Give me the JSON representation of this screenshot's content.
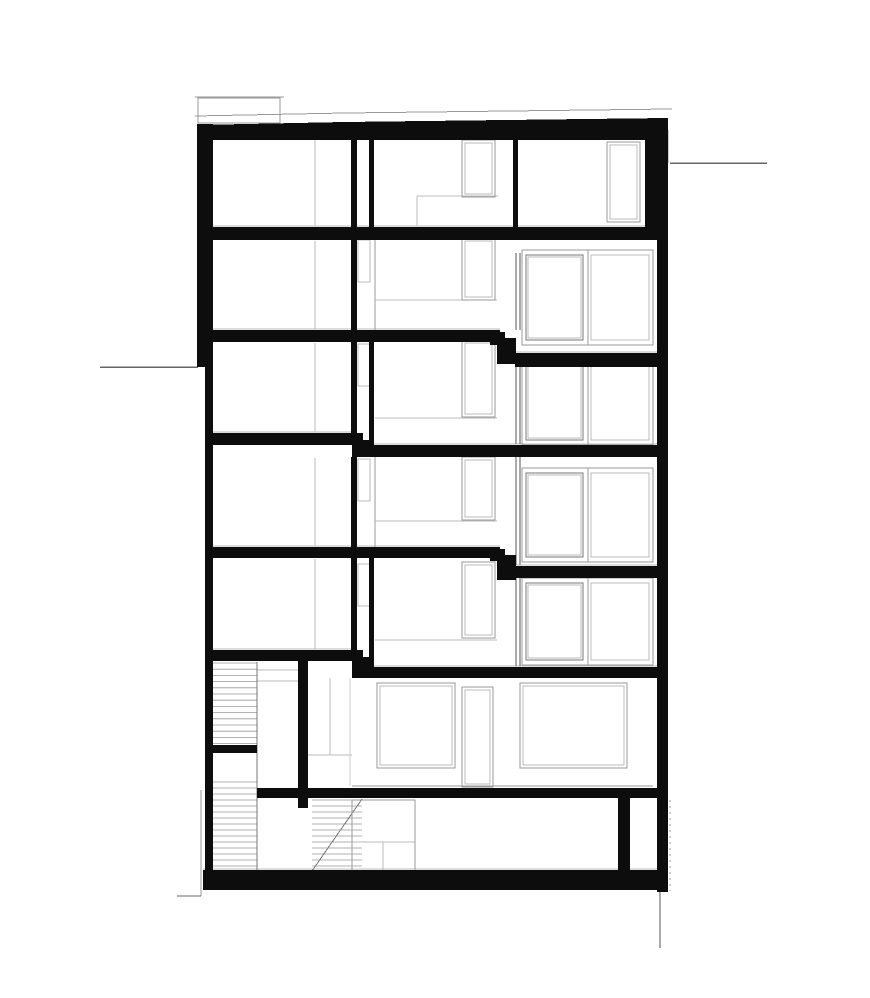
{
  "title": "building-section-drawing",
  "canvas": {
    "width": 870,
    "height": 998,
    "background": "#ffffff"
  },
  "colors": {
    "cut": "#0d0d0d",
    "thin": "#999999",
    "mid": "#777777",
    "light": "#bbbbbb",
    "faint": "#cccccc",
    "dark": "#555555",
    "grade": "#666666"
  },
  "drawing": {
    "roof_polygon": {
      "name": "roof-slab",
      "points": [
        [
          197,
          125
        ],
        [
          345,
          122
        ],
        [
          668,
          118
        ],
        [
          668,
          140
        ],
        [
          197,
          140
        ]
      ]
    },
    "black_rects": [
      {
        "name": "exterior-wall-left-upper",
        "r": [
          197,
          124,
          16,
          243
        ]
      },
      {
        "name": "exterior-wall-left-lower",
        "r": [
          205,
          367,
          8,
          519
        ]
      },
      {
        "name": "exterior-wall-right-top",
        "r": [
          645,
          124,
          23,
          116
        ]
      },
      {
        "name": "exterior-wall-right",
        "r": [
          657,
          240,
          11,
          652
        ]
      },
      {
        "name": "floor-slab-2",
        "r": [
          213,
          227,
          445,
          13
        ]
      },
      {
        "name": "partition-wall-top-floor",
        "r": [
          513,
          140,
          5,
          87
        ]
      },
      {
        "name": "floor-slab-3-left",
        "r": [
          213,
          330,
          287,
          12
        ]
      },
      {
        "name": "slab-step",
        "r": [
          490,
          332,
          15,
          13
        ]
      },
      {
        "name": "slab-step",
        "r": [
          497,
          338,
          19,
          26
        ]
      },
      {
        "name": "floor-slab-3-right",
        "r": [
          515,
          353,
          143,
          14
        ]
      },
      {
        "name": "floor-slab-4-left",
        "r": [
          213,
          433,
          139,
          12
        ]
      },
      {
        "name": "slab-step",
        "r": [
          352,
          433,
          11,
          13
        ]
      },
      {
        "name": "slab-step",
        "r": [
          352,
          440,
          21,
          17
        ]
      },
      {
        "name": "floor-slab-4-right",
        "r": [
          370,
          445,
          288,
          12
        ]
      },
      {
        "name": "floor-slab-5-left",
        "r": [
          213,
          547,
          287,
          11
        ]
      },
      {
        "name": "slab-step",
        "r": [
          490,
          549,
          15,
          12
        ]
      },
      {
        "name": "slab-step",
        "r": [
          497,
          555,
          19,
          25
        ]
      },
      {
        "name": "floor-slab-5-right",
        "r": [
          515,
          566,
          143,
          12
        ]
      },
      {
        "name": "floor-slab-6-left",
        "r": [
          213,
          650,
          139,
          11
        ]
      },
      {
        "name": "slab-step",
        "r": [
          352,
          650,
          11,
          12
        ]
      },
      {
        "name": "slab-step",
        "r": [
          352,
          657,
          21,
          21
        ]
      },
      {
        "name": "floor-slab-6-right",
        "r": [
          370,
          667,
          288,
          11
        ]
      },
      {
        "name": "interior-wall",
        "r": [
          351,
          139,
          6,
          88
        ]
      },
      {
        "name": "interior-wall",
        "r": [
          351,
          240,
          6,
          90
        ]
      },
      {
        "name": "interior-wall",
        "r": [
          351,
          342,
          6,
          98
        ]
      },
      {
        "name": "interior-wall",
        "r": [
          351,
          457,
          6,
          90
        ]
      },
      {
        "name": "interior-wall",
        "r": [
          351,
          558,
          6,
          99
        ]
      },
      {
        "name": "interior-wall",
        "r": [
          369,
          140,
          5,
          87
        ]
      },
      {
        "name": "interior-wall",
        "r": [
          369,
          342,
          5,
          103
        ]
      },
      {
        "name": "interior-wall",
        "r": [
          369,
          558,
          5,
          109
        ]
      },
      {
        "name": "stair-core-wall",
        "r": [
          298,
          661,
          10,
          147
        ]
      },
      {
        "name": "stair-landing-slab",
        "r": [
          205,
          745,
          52,
          8
        ]
      },
      {
        "name": "garden-level-slab",
        "r": [
          257,
          788,
          401,
          10
        ]
      },
      {
        "name": "foundation-slab",
        "r": [
          203,
          870,
          465,
          20
        ]
      },
      {
        "name": "basement-wall",
        "r": [
          618,
          798,
          12,
          74
        ]
      }
    ],
    "lines": [
      {
        "name": "roof-edge-line",
        "l": [
          195,
          116,
          345,
          113
        ],
        "c": "thin",
        "w": 1
      },
      {
        "name": "roof-edge-line",
        "l": [
          345,
          113,
          672,
          109
        ],
        "c": "thin",
        "w": 1
      },
      {
        "name": "chimney-top-line",
        "l": [
          195,
          97,
          284,
          97
        ],
        "c": "thin",
        "w": 1
      },
      {
        "name": "grade-line-right",
        "l": [
          670,
          163,
          767,
          163
        ],
        "c": "grade",
        "w": 1.5
      },
      {
        "name": "grade-line-right-v",
        "l": [
          668,
          130,
          668,
          163
        ],
        "c": "thin",
        "w": 1
      },
      {
        "name": "grade-line-left",
        "l": [
          100,
          367,
          198,
          367
        ],
        "c": "grade",
        "w": 1.5
      },
      {
        "name": "footing-line-left-v",
        "l": [
          201,
          790,
          201,
          896
        ],
        "c": "thin",
        "w": 1
      },
      {
        "name": "footing-line-left-h",
        "l": [
          177,
          896,
          201,
          896
        ],
        "c": "grade",
        "w": 1
      },
      {
        "name": "footing-line-right",
        "l": [
          660,
          892,
          660,
          948
        ],
        "c": "dark",
        "w": 1
      },
      {
        "name": "slab-finish-line",
        "l": [
          213,
          226,
          658,
          226
        ],
        "c": "light",
        "w": 1
      },
      {
        "name": "slab-finish-line",
        "l": [
          213,
          329,
          500,
          329
        ],
        "c": "light",
        "w": 1
      },
      {
        "name": "slab-finish-line",
        "l": [
          515,
          352,
          658,
          352
        ],
        "c": "light",
        "w": 1
      },
      {
        "name": "slab-finish-line",
        "l": [
          213,
          432,
          352,
          432
        ],
        "c": "light",
        "w": 1
      },
      {
        "name": "slab-finish-line",
        "l": [
          370,
          444,
          658,
          444
        ],
        "c": "light",
        "w": 1
      },
      {
        "name": "slab-finish-line",
        "l": [
          213,
          546,
          500,
          546
        ],
        "c": "light",
        "w": 1
      },
      {
        "name": "slab-finish-line",
        "l": [
          515,
          565,
          658,
          565
        ],
        "c": "light",
        "w": 1
      },
      {
        "name": "slab-finish-line",
        "l": [
          213,
          649,
          352,
          649
        ],
        "c": "light",
        "w": 1
      },
      {
        "name": "slab-finish-line",
        "l": [
          370,
          666,
          658,
          666
        ],
        "c": "light",
        "w": 1
      },
      {
        "name": "slab-finish-line",
        "l": [
          203,
          869,
          668,
          869
        ],
        "c": "light",
        "w": 1
      },
      {
        "name": "door-frame-line",
        "l": [
          315,
          140,
          315,
          226
        ],
        "c": "light",
        "w": 1
      },
      {
        "name": "door-frame-line",
        "l": [
          315,
          241,
          315,
          329
        ],
        "c": "light",
        "w": 1
      },
      {
        "name": "door-frame-line",
        "l": [
          315,
          343,
          315,
          432
        ],
        "c": "light",
        "w": 1
      },
      {
        "name": "door-frame-line",
        "l": [
          315,
          458,
          315,
          546
        ],
        "c": "light",
        "w": 1
      },
      {
        "name": "door-frame-line",
        "l": [
          315,
          559,
          315,
          649
        ],
        "c": "light",
        "w": 1
      },
      {
        "name": "shaft-edge-line",
        "l": [
          375,
          240,
          375,
          330
        ],
        "c": "thin",
        "w": 1
      },
      {
        "name": "shaft-edge-line",
        "l": [
          375,
          457,
          375,
          547
        ],
        "c": "thin",
        "w": 1
      },
      {
        "name": "partition-edge-line",
        "l": [
          516,
          253,
          516,
          330
        ],
        "c": "dark",
        "w": 1
      },
      {
        "name": "partition-edge-line",
        "l": [
          520,
          253,
          520,
          330
        ],
        "c": "dark",
        "w": 1
      },
      {
        "name": "partition-edge-line",
        "l": [
          516,
          365,
          516,
          444
        ],
        "c": "dark",
        "w": 1
      },
      {
        "name": "partition-edge-line",
        "l": [
          520,
          365,
          520,
          444
        ],
        "c": "dark",
        "w": 1
      },
      {
        "name": "partition-edge-line",
        "l": [
          516,
          457,
          516,
          565
        ],
        "c": "dark",
        "w": 1
      },
      {
        "name": "partition-edge-line",
        "l": [
          520,
          457,
          520,
          565
        ],
        "c": "dark",
        "w": 1
      },
      {
        "name": "partition-edge-line",
        "l": [
          516,
          578,
          516,
          666
        ],
        "c": "dark",
        "w": 1
      },
      {
        "name": "partition-edge-line",
        "l": [
          520,
          578,
          520,
          666
        ],
        "c": "dark",
        "w": 1
      },
      {
        "name": "loft-outline",
        "l": [
          417,
          196,
          498,
          196
        ],
        "c": "light",
        "w": 1
      },
      {
        "name": "loft-outline",
        "l": [
          417,
          196,
          417,
          226
        ],
        "c": "light",
        "w": 1
      },
      {
        "name": "interior-floor-line",
        "l": [
          375,
          300,
          497,
          300
        ],
        "c": "light",
        "w": 1
      },
      {
        "name": "interior-floor-line",
        "l": [
          375,
          418,
          497,
          418
        ],
        "c": "light",
        "w": 1
      },
      {
        "name": "interior-floor-line",
        "l": [
          375,
          521,
          497,
          521
        ],
        "c": "light",
        "w": 1
      },
      {
        "name": "interior-floor-line",
        "l": [
          375,
          640,
          497,
          640
        ],
        "c": "light",
        "w": 1
      },
      {
        "name": "garden-floor-line",
        "l": [
          352,
          786,
          653,
          786
        ],
        "c": "thin",
        "w": 1
      },
      {
        "name": "garden-partition-line",
        "l": [
          330,
          678,
          330,
          755
        ],
        "c": "light",
        "w": 1
      },
      {
        "name": "garden-partition-line",
        "l": [
          308,
          755,
          352,
          755
        ],
        "c": "light",
        "w": 1
      },
      {
        "name": "garden-partition-line",
        "l": [
          350,
          678,
          350,
          786
        ],
        "c": "faint",
        "w": 1
      },
      {
        "name": "stair-landing-line",
        "l": [
          257,
          670,
          298,
          670
        ],
        "c": "light",
        "w": 1
      },
      {
        "name": "stair-landing-line",
        "l": [
          257,
          681,
          298,
          681
        ],
        "c": "light",
        "w": 1
      },
      {
        "name": "stair-well-line",
        "l": [
          257,
          662,
          257,
          872
        ],
        "c": "mid",
        "w": 1
      },
      {
        "name": "basement-cabinet-line",
        "l": [
          352,
          842,
          415,
          842
        ],
        "c": "light",
        "w": 1
      },
      {
        "name": "basement-cabinet-line",
        "l": [
          383,
          842,
          383,
          877
        ],
        "c": "light",
        "w": 1
      },
      {
        "name": "stair-stringer-diagonal",
        "l": [
          312,
          871,
          362,
          799
        ],
        "c": "mid",
        "w": 1
      }
    ],
    "outline_rects": [
      {
        "name": "chimney-outline",
        "r": [
          198,
          98,
          82,
          25
        ],
        "c": "thin"
      },
      {
        "name": "basement-cabinet-outline",
        "r": [
          352,
          800,
          63,
          77
        ],
        "c": "thin"
      }
    ],
    "window_frames": [
      {
        "name": "window-frame",
        "r": [
          462,
          140,
          33,
          57
        ]
      },
      {
        "name": "window-frame",
        "r": [
          462,
          238,
          33,
          62
        ]
      },
      {
        "name": "window-frame",
        "r": [
          462,
          340,
          33,
          77
        ]
      },
      {
        "name": "window-frame",
        "r": [
          462,
          457,
          33,
          63
        ]
      },
      {
        "name": "window-frame",
        "r": [
          462,
          562,
          33,
          76
        ]
      },
      {
        "name": "window-frame",
        "r": [
          607,
          142,
          33,
          80
        ]
      },
      {
        "name": "door-frame",
        "r": [
          462,
          687,
          31,
          100
        ]
      },
      {
        "name": "window-frame",
        "r": [
          377,
          683,
          78,
          85
        ]
      },
      {
        "name": "window-frame",
        "r": [
          520,
          683,
          107,
          85
        ]
      }
    ],
    "shaft_windows": [
      {
        "name": "shaft-window",
        "r": [
          358,
          240,
          12,
          42
        ]
      },
      {
        "name": "shaft-window",
        "r": [
          358,
          344,
          12,
          42
        ]
      },
      {
        "name": "shaft-window",
        "r": [
          358,
          459,
          12,
          42
        ]
      },
      {
        "name": "shaft-window",
        "r": [
          358,
          564,
          12,
          42
        ]
      }
    ],
    "glazing_units": [
      {
        "name": "glazing-unit",
        "r": [
          522,
          250,
          131,
          95
        ],
        "divider": 66
      },
      {
        "name": "glazing-unit",
        "r": [
          522,
          358,
          131,
          87
        ],
        "divider": 66
      },
      {
        "name": "glazing-unit",
        "r": [
          522,
          468,
          131,
          94
        ],
        "divider": 66
      },
      {
        "name": "glazing-unit",
        "r": [
          522,
          578,
          131,
          87
        ],
        "divider": 66
      }
    ],
    "stair_hatches": [
      {
        "name": "stair-flight-upper",
        "r": [
          213,
          663,
          44,
          81
        ],
        "step": 6.2
      },
      {
        "name": "stair-flight-lower",
        "r": [
          212,
          782,
          45,
          89
        ],
        "step": 6
      },
      {
        "name": "stair-flight-basement",
        "r": [
          312,
          800,
          50,
          70
        ],
        "step": 6
      }
    ],
    "dashed_lines": [
      {
        "name": "hidden-edge-dashed",
        "l": [
          670,
          800,
          670,
          891
        ],
        "c": "thin",
        "w": 1,
        "dash": "2,4"
      }
    ]
  }
}
